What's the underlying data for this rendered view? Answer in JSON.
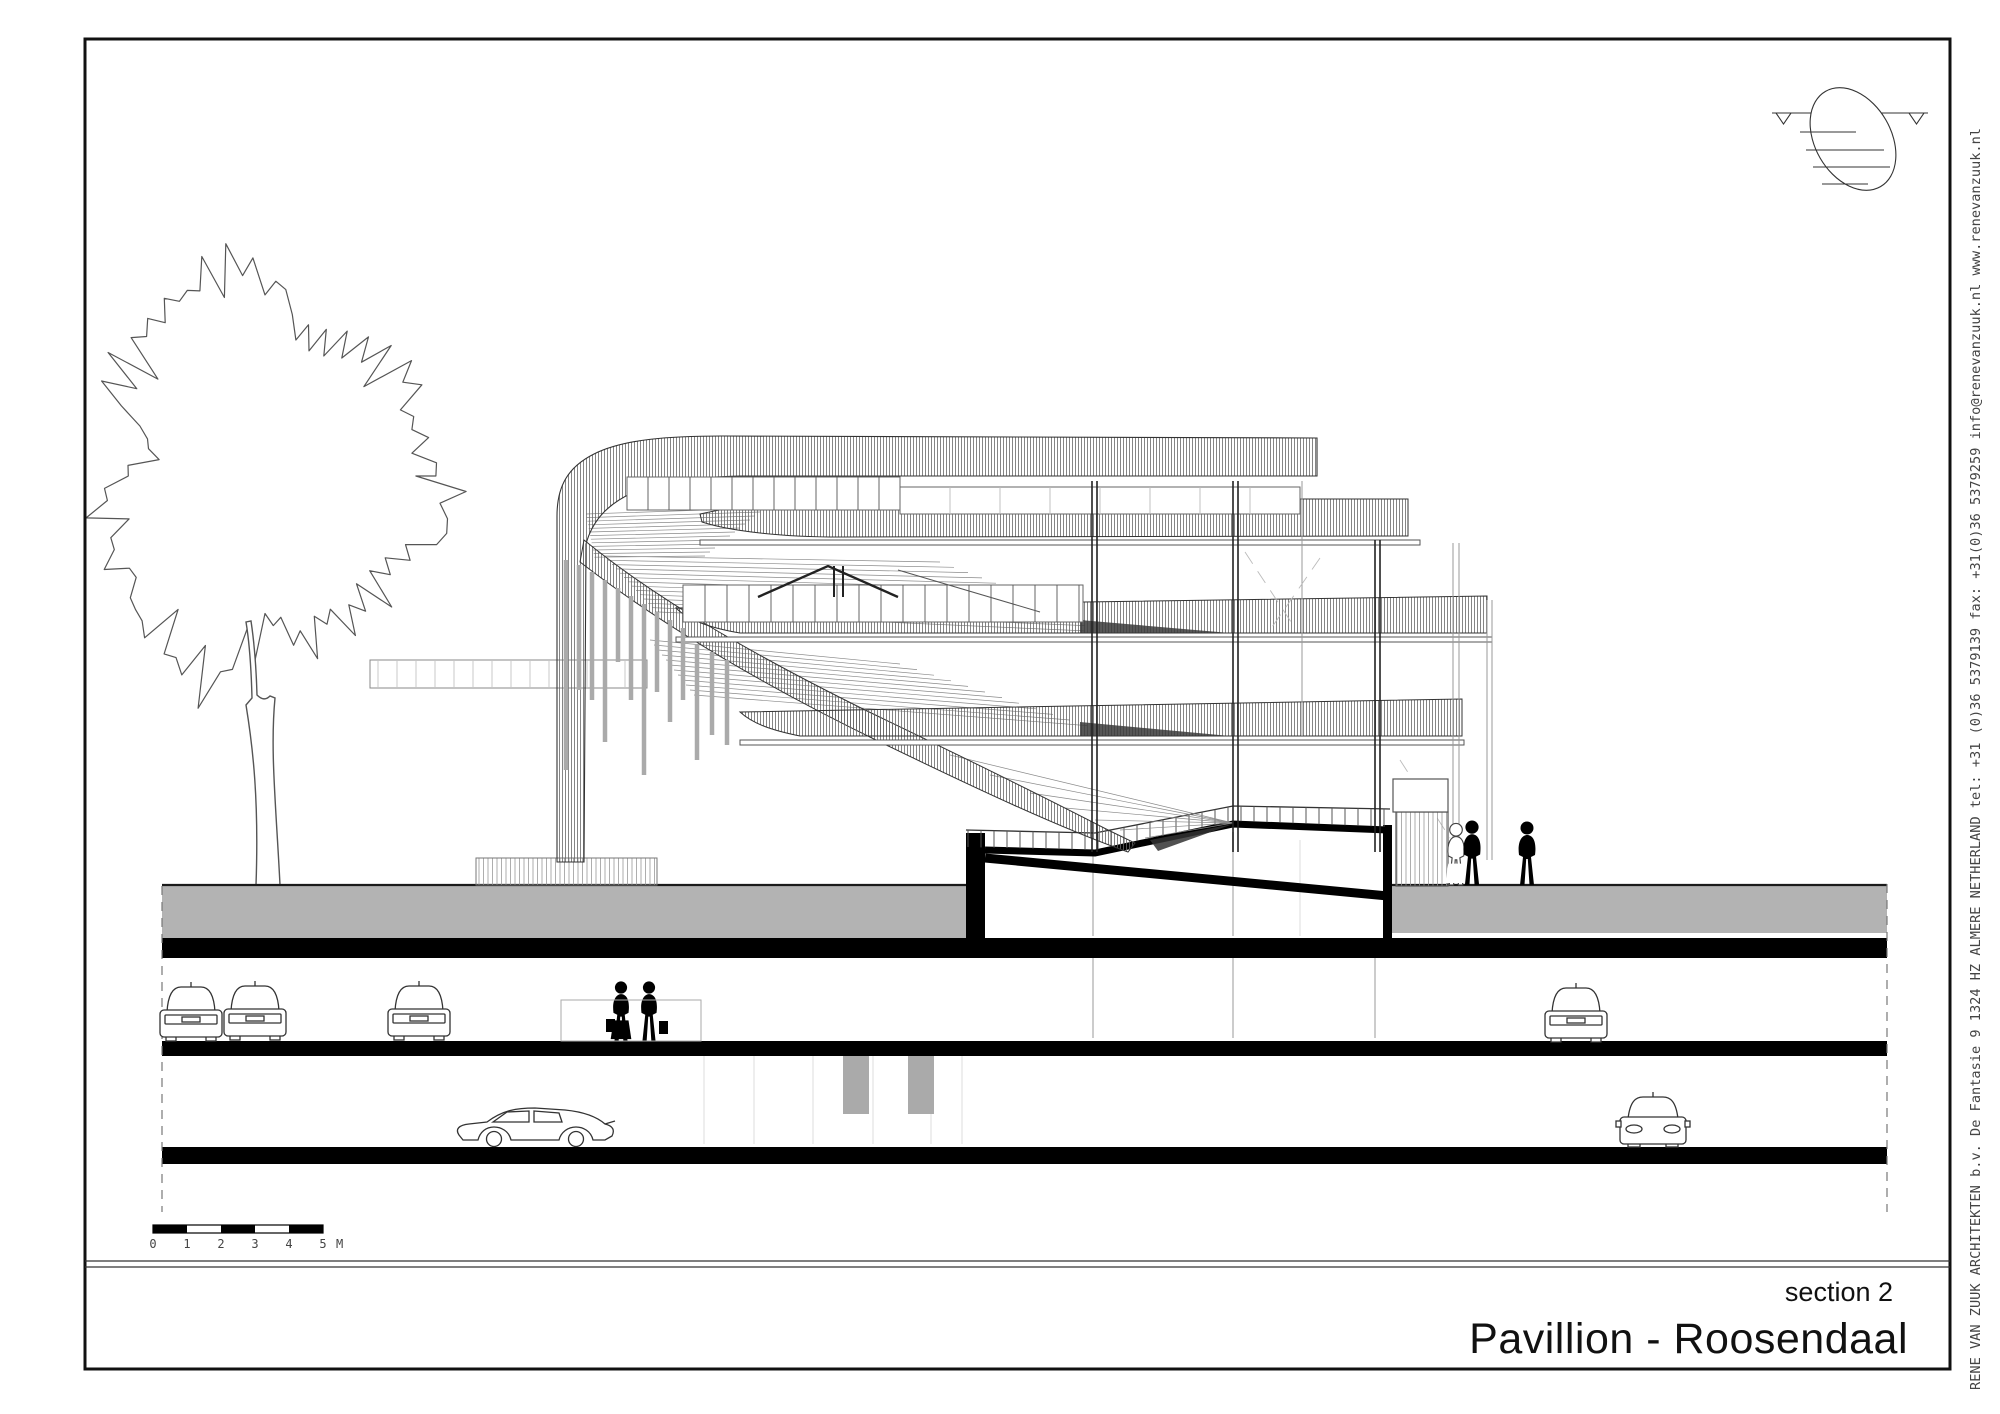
{
  "title_block": {
    "drawing_label": "section 2",
    "project_title": "Pavillion - Roosendaal"
  },
  "firm_strip": {
    "firm": "RENE VAN ZUUK ARCHITEKTEN b.v.",
    "address": "De Fantasie 9",
    "postcode": "1324 HZ",
    "city": "ALMERE",
    "country": "NETHERLAND",
    "tel": "tel: +31 (0)36 5379139",
    "fax": "fax: +31(0)36 5379259",
    "email": "info@renevanzuuk.nl",
    "website": "www.renevanzuuk.nl",
    "combined": "RENE VAN ZUUK ARCHITEKTEN b.v.    De Fantasie 9   1324 HZ   ALMERE   NETHERLAND    tel: +31 (0)36 5379139   fax: +31(0)36 5379259   info@renevanzuuk.nl    www.renevanzuuk.nl"
  },
  "scale_bar": {
    "labels": [
      "0",
      "1",
      "2",
      "3",
      "4",
      "5"
    ],
    "unit": "M"
  },
  "icons": {
    "logo": "architect-egg-logo-icon",
    "scale": "scale-bar",
    "people": "person-silhouette-icon",
    "vehicles": "car-icon"
  },
  "colors": {
    "ground_gray": "#b3b3b3",
    "section_cut": "#000000",
    "line": "#333333",
    "hatch": "#666666"
  }
}
